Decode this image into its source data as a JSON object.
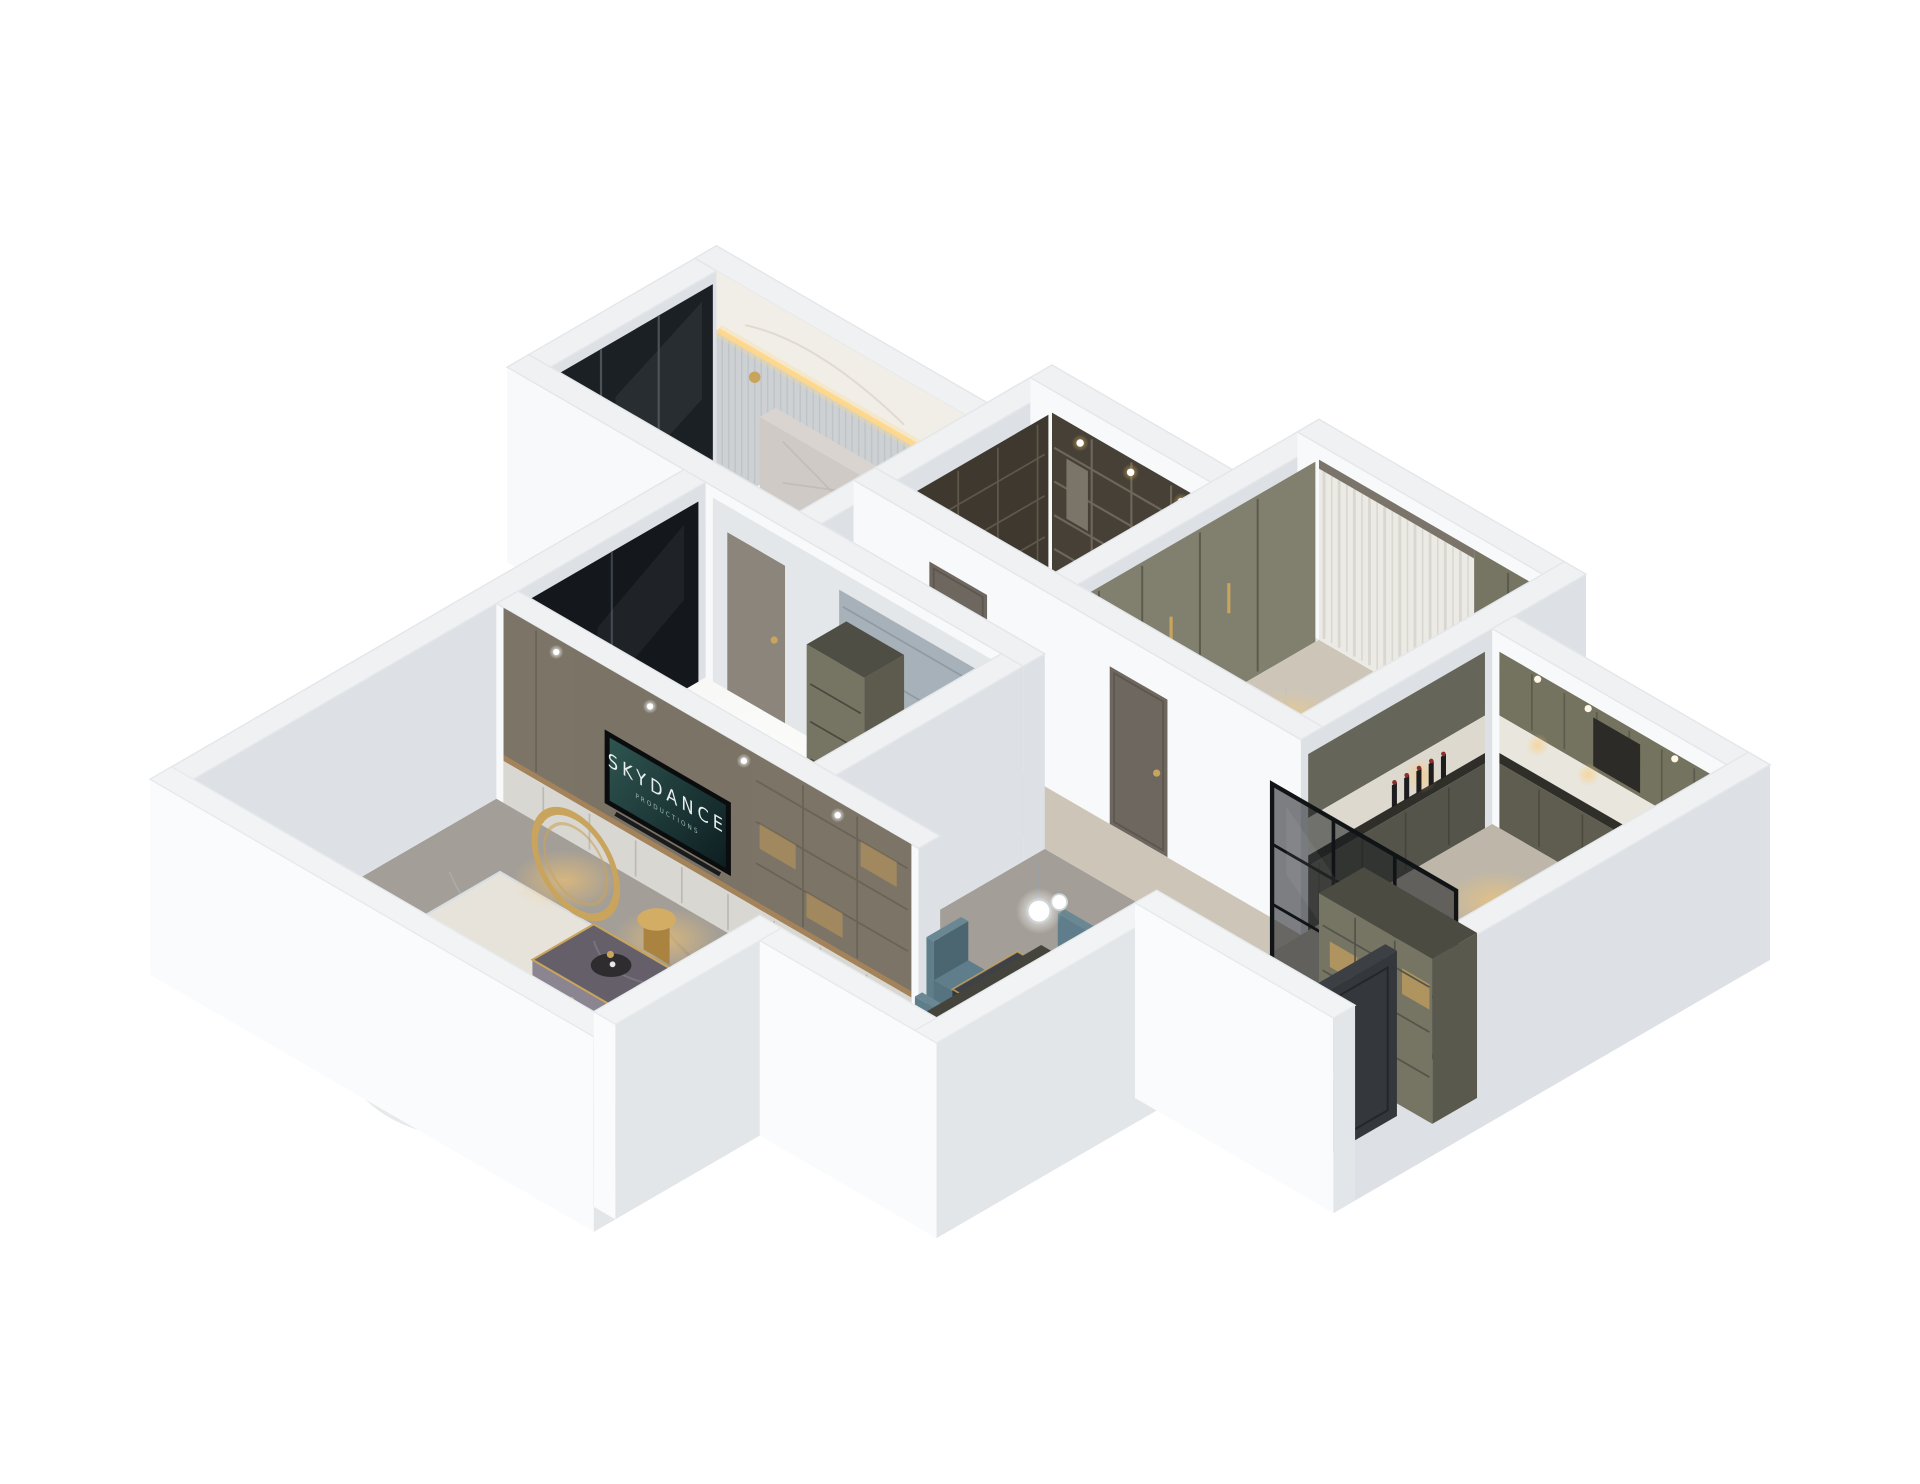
{
  "scene": {
    "type": "isometric-apartment-3d-render",
    "background": "#ffffff",
    "tv_screen": {
      "title": "SKYDANCE",
      "subtitle": "PRODUCTIONS"
    },
    "rooms": [
      "master-bedroom",
      "walk-in-closet",
      "dressing-room",
      "kitchen",
      "hallway",
      "second-bedroom",
      "living-room",
      "dining-area",
      "entry-hall"
    ],
    "objects": [
      "bed",
      "headboard",
      "nightstand",
      "closet-shelves",
      "sheer-curtains",
      "wardrobe",
      "kitchen-cabinets",
      "glass-partition",
      "tv-wall",
      "tv-screen",
      "sectional-sofa",
      "coffee-table",
      "gold-ring-decor",
      "gold-drum-stool",
      "accent-chair",
      "area-rug",
      "dining-table",
      "dining-chairs",
      "dining-rug",
      "pendant-lamp",
      "display-cabinet",
      "entry-door",
      "balcony-windows"
    ],
    "palette": {
      "wall_top": "#f0f1f3",
      "wall_light": "#f8f9fa",
      "wall_shade": "#dde1e5",
      "floor_grey": "#a39e97",
      "floor_vein_dark": "#837e76",
      "floor_vein_light": "#c6c1b9",
      "floor_beige": "#cdc6b8",
      "floor_kitchen": "#bdb6a9",
      "floor_closet": "#6b6459",
      "floor_bed": "#b6aea2",
      "floor_white": "#f3f3f0",
      "glass_dark": "#1b2025",
      "glass_living": "#2f363d",
      "frame_light": "#9aa0a5",
      "curtain": "#eceae4",
      "curtain_stripe": "#d8d5cd",
      "pelmet": "#7a746b",
      "olive": "#767564",
      "olive_shade": "#5c5b4d",
      "olive_light": "#81806f",
      "cab_up": "#74735f",
      "cab_low": "#5e5d4f",
      "counter": "#2f2e29",
      "backsplash": "#e9e6de",
      "hood": "#2c2b27",
      "shelf_dark": "#464036",
      "shelf_line": "#6f6659",
      "tv_taupe": "#8d8678",
      "tv_taupe2": "#7c7567",
      "tv_panel": "#7b7466",
      "console": "#d9d7d2",
      "wood": "#a5835a",
      "screen_hi": "#2f5551",
      "screen_lo": "#0d1e21",
      "tv_text": "#e6efed",
      "sofa": "#7e96a9",
      "sofa_top": "#8ba2b3",
      "sofa_shade": "#68808f",
      "cushion": "#5f7787",
      "pillow1": "#9fb3c2",
      "pillow2": "#b7c6d2",
      "rug_blue": "#bec9d3",
      "rug_dot": "#a6b3c0",
      "rug_cream": "#e9e5db",
      "table_dark": "#3e4147",
      "table_side": "#2e3136",
      "chair_teal": "#5f7d8a",
      "chair_shade": "#4c6671",
      "chair_mid": "#567380",
      "gold": "#c9a45c",
      "gold_deep": "#a9833f",
      "glow_warm": "#ffc96a",
      "marble_wall": "#f1eee8",
      "panel_grey": "#cdd1d3",
      "panel_blue": "#a7b1b9",
      "beige_chair": "#d7ab77",
      "beige_chair_dk": "#c59a69",
      "beige_cushion": "#e6c296",
      "door_dark": "#3f4246",
      "door_taupe": "#6e675f",
      "wood_slat": "#8a6a46",
      "wood_slat_dk": "#6f5233",
      "ctable_top": "#655f6a",
      "ctable_side": "#8a8590",
      "ctable_px": "#78737e",
      "shadow": "rgba(100,105,112,0.15)"
    }
  }
}
